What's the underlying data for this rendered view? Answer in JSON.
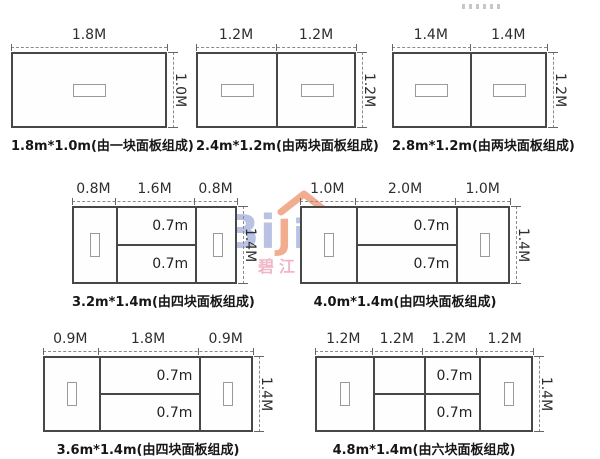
{
  "watermark": {
    "brand_prefix": "Bi",
    "brand_accent": "J",
    "brand_suffix": "ion",
    "subtitle": "碧江家居",
    "colors": {
      "blue": "#b6bfe2",
      "orange": "#f2a98c",
      "pink": "#f0b3c4"
    }
  },
  "colors": {
    "box_line": "#474747",
    "dim_line": "#8b8b8b",
    "text": "#161616"
  },
  "diagrams": [
    {
      "caption": "1.8m*1.0m(由一块面板组成)",
      "top_labels": [
        "1.8M"
      ],
      "side_label": "1.0M",
      "row_labels": []
    },
    {
      "caption": "2.4m*1.2m(由两块面板组成)",
      "top_labels": [
        "1.2M",
        "1.2M"
      ],
      "side_label": "1.2M",
      "row_labels": []
    },
    {
      "caption": "2.8m*1.2m(由两块面板组成)",
      "top_labels": [
        "1.4M",
        "1.4M"
      ],
      "side_label": "1.2M",
      "row_labels": []
    },
    {
      "caption": "3.2m*1.4m(由四块面板组成)",
      "top_labels": [
        "0.8M",
        "1.6M",
        "0.8M"
      ],
      "side_label": "1.4M",
      "row_labels": [
        "0.7m",
        "0.7m"
      ]
    },
    {
      "caption": "4.0m*1.4m(由四块面板组成)",
      "top_labels": [
        "1.0M",
        "2.0M",
        "1.0M"
      ],
      "side_label": "1.4M",
      "row_labels": [
        "0.7m",
        "0.7m"
      ]
    },
    {
      "caption": "3.6m*1.4m(由四块面板组成)",
      "top_labels": [
        "0.9M",
        "1.8M",
        "0.9M"
      ],
      "side_label": "1.4M",
      "row_labels": [
        "0.7m",
        "0.7m"
      ]
    },
    {
      "caption": "4.8m*1.4m(由六块面板组成)",
      "top_labels": [
        "1.2M",
        "1.2M",
        "1.2M",
        "1.2M"
      ],
      "side_label": "1.4M",
      "row_labels": [
        "0.7m",
        "0.7m"
      ]
    }
  ]
}
